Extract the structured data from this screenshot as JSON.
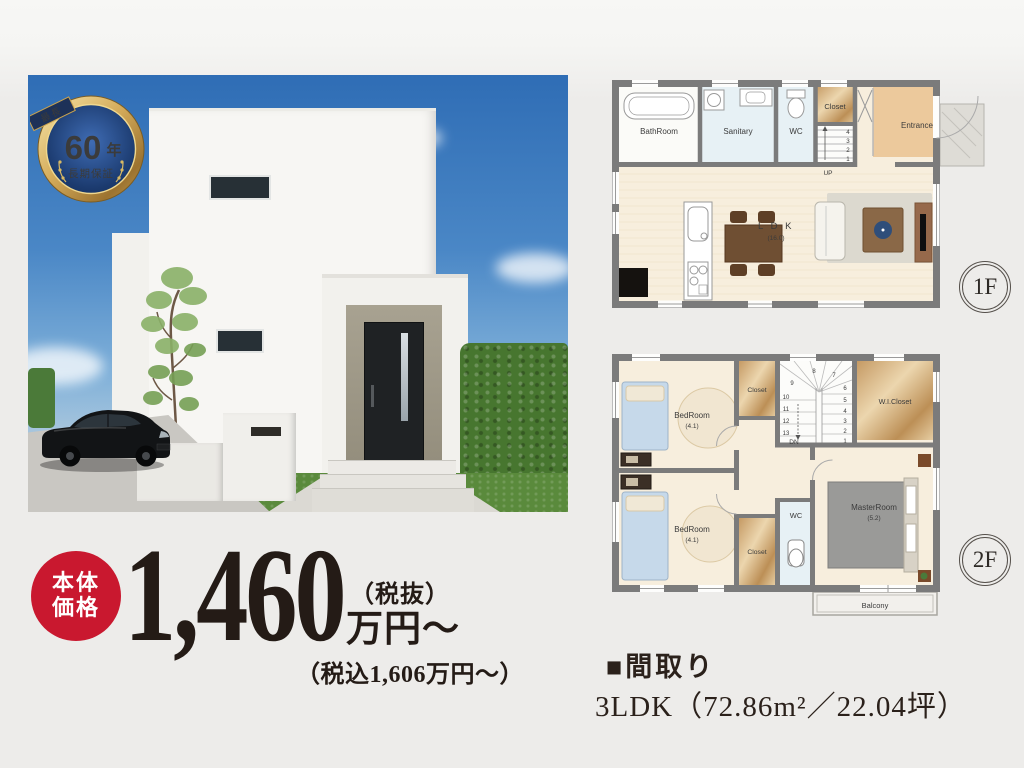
{
  "page": {
    "background_color": "#edecea"
  },
  "badge": {
    "ribbon": "最長",
    "number": "60",
    "unit": "年",
    "caption": "長期保証"
  },
  "price": {
    "label_top": "本体",
    "label_bottom": "価格",
    "amount": "1,460",
    "tax_note": "（税抜）",
    "unit": "万円〜",
    "tax_included": "（税込1,606万円〜）",
    "badge_color": "#c9182f",
    "text_color": "#241b16"
  },
  "floor1": {
    "badge": "1F",
    "rooms": {
      "bathroom": "BathRoom",
      "sanitary": "Sanitary",
      "wc": "WC",
      "closet": "Closet",
      "entrance": "Entrance",
      "ldk": "L D K",
      "ldk_size": "(16.0)"
    },
    "stairs": {
      "up": "UP",
      "numbers": [
        "4",
        "3",
        "2",
        "1"
      ]
    }
  },
  "floor2": {
    "badge": "2F",
    "rooms": {
      "bedroom_top": "BedRoom",
      "bedroom_top_size": "(4.1)",
      "closet_top": "Closet",
      "wi_closet": "W.I.Closet",
      "bedroom_bottom": "BedRoom",
      "bedroom_bottom_size": "(4.1)",
      "closet_bottom": "Closet",
      "wc": "WC",
      "master": "MasterRoom",
      "master_size": "(5.2)",
      "balcony": "Balcony"
    },
    "stairs": {
      "dn": "DN",
      "numbers_top": [
        "8",
        "7"
      ],
      "numbers_left": [
        "9",
        "10",
        "11",
        "12",
        "13"
      ],
      "numbers_right": [
        "6",
        "5",
        "4",
        "3",
        "2",
        "1"
      ]
    }
  },
  "madori": {
    "heading": "■間取り",
    "spec": "3LDK（72.86m²／22.04坪）"
  }
}
